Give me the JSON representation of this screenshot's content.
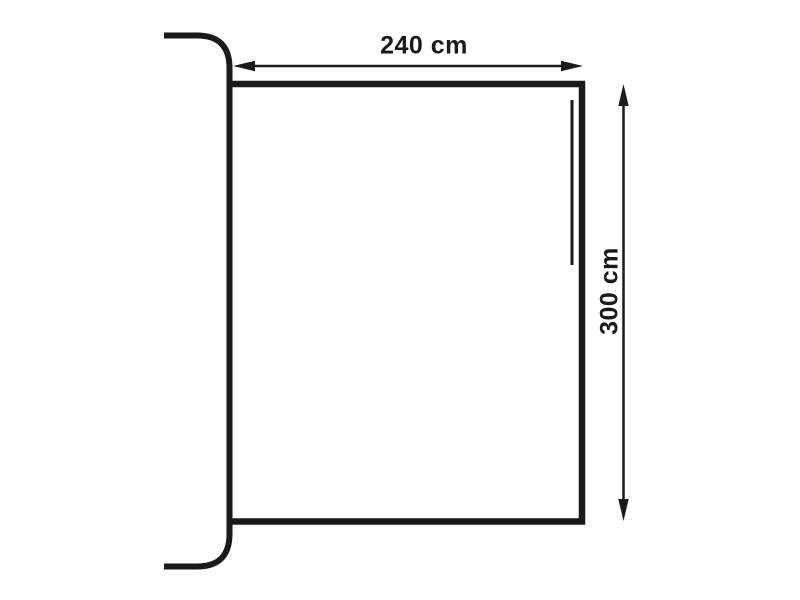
{
  "diagram": {
    "type": "technical-dimension-drawing",
    "subject": "awning-canopy-attached-to-caravan-side-wall",
    "dimensions": {
      "width_label": "240 cm",
      "height_label": "300 cm"
    },
    "colors": {
      "stroke": "#1a1a1a",
      "background": "#ffffff"
    },
    "icons": {
      "width_arrow": "double-headed-horizontal-arrow",
      "height_arrow": "double-headed-vertical-arrow"
    }
  }
}
